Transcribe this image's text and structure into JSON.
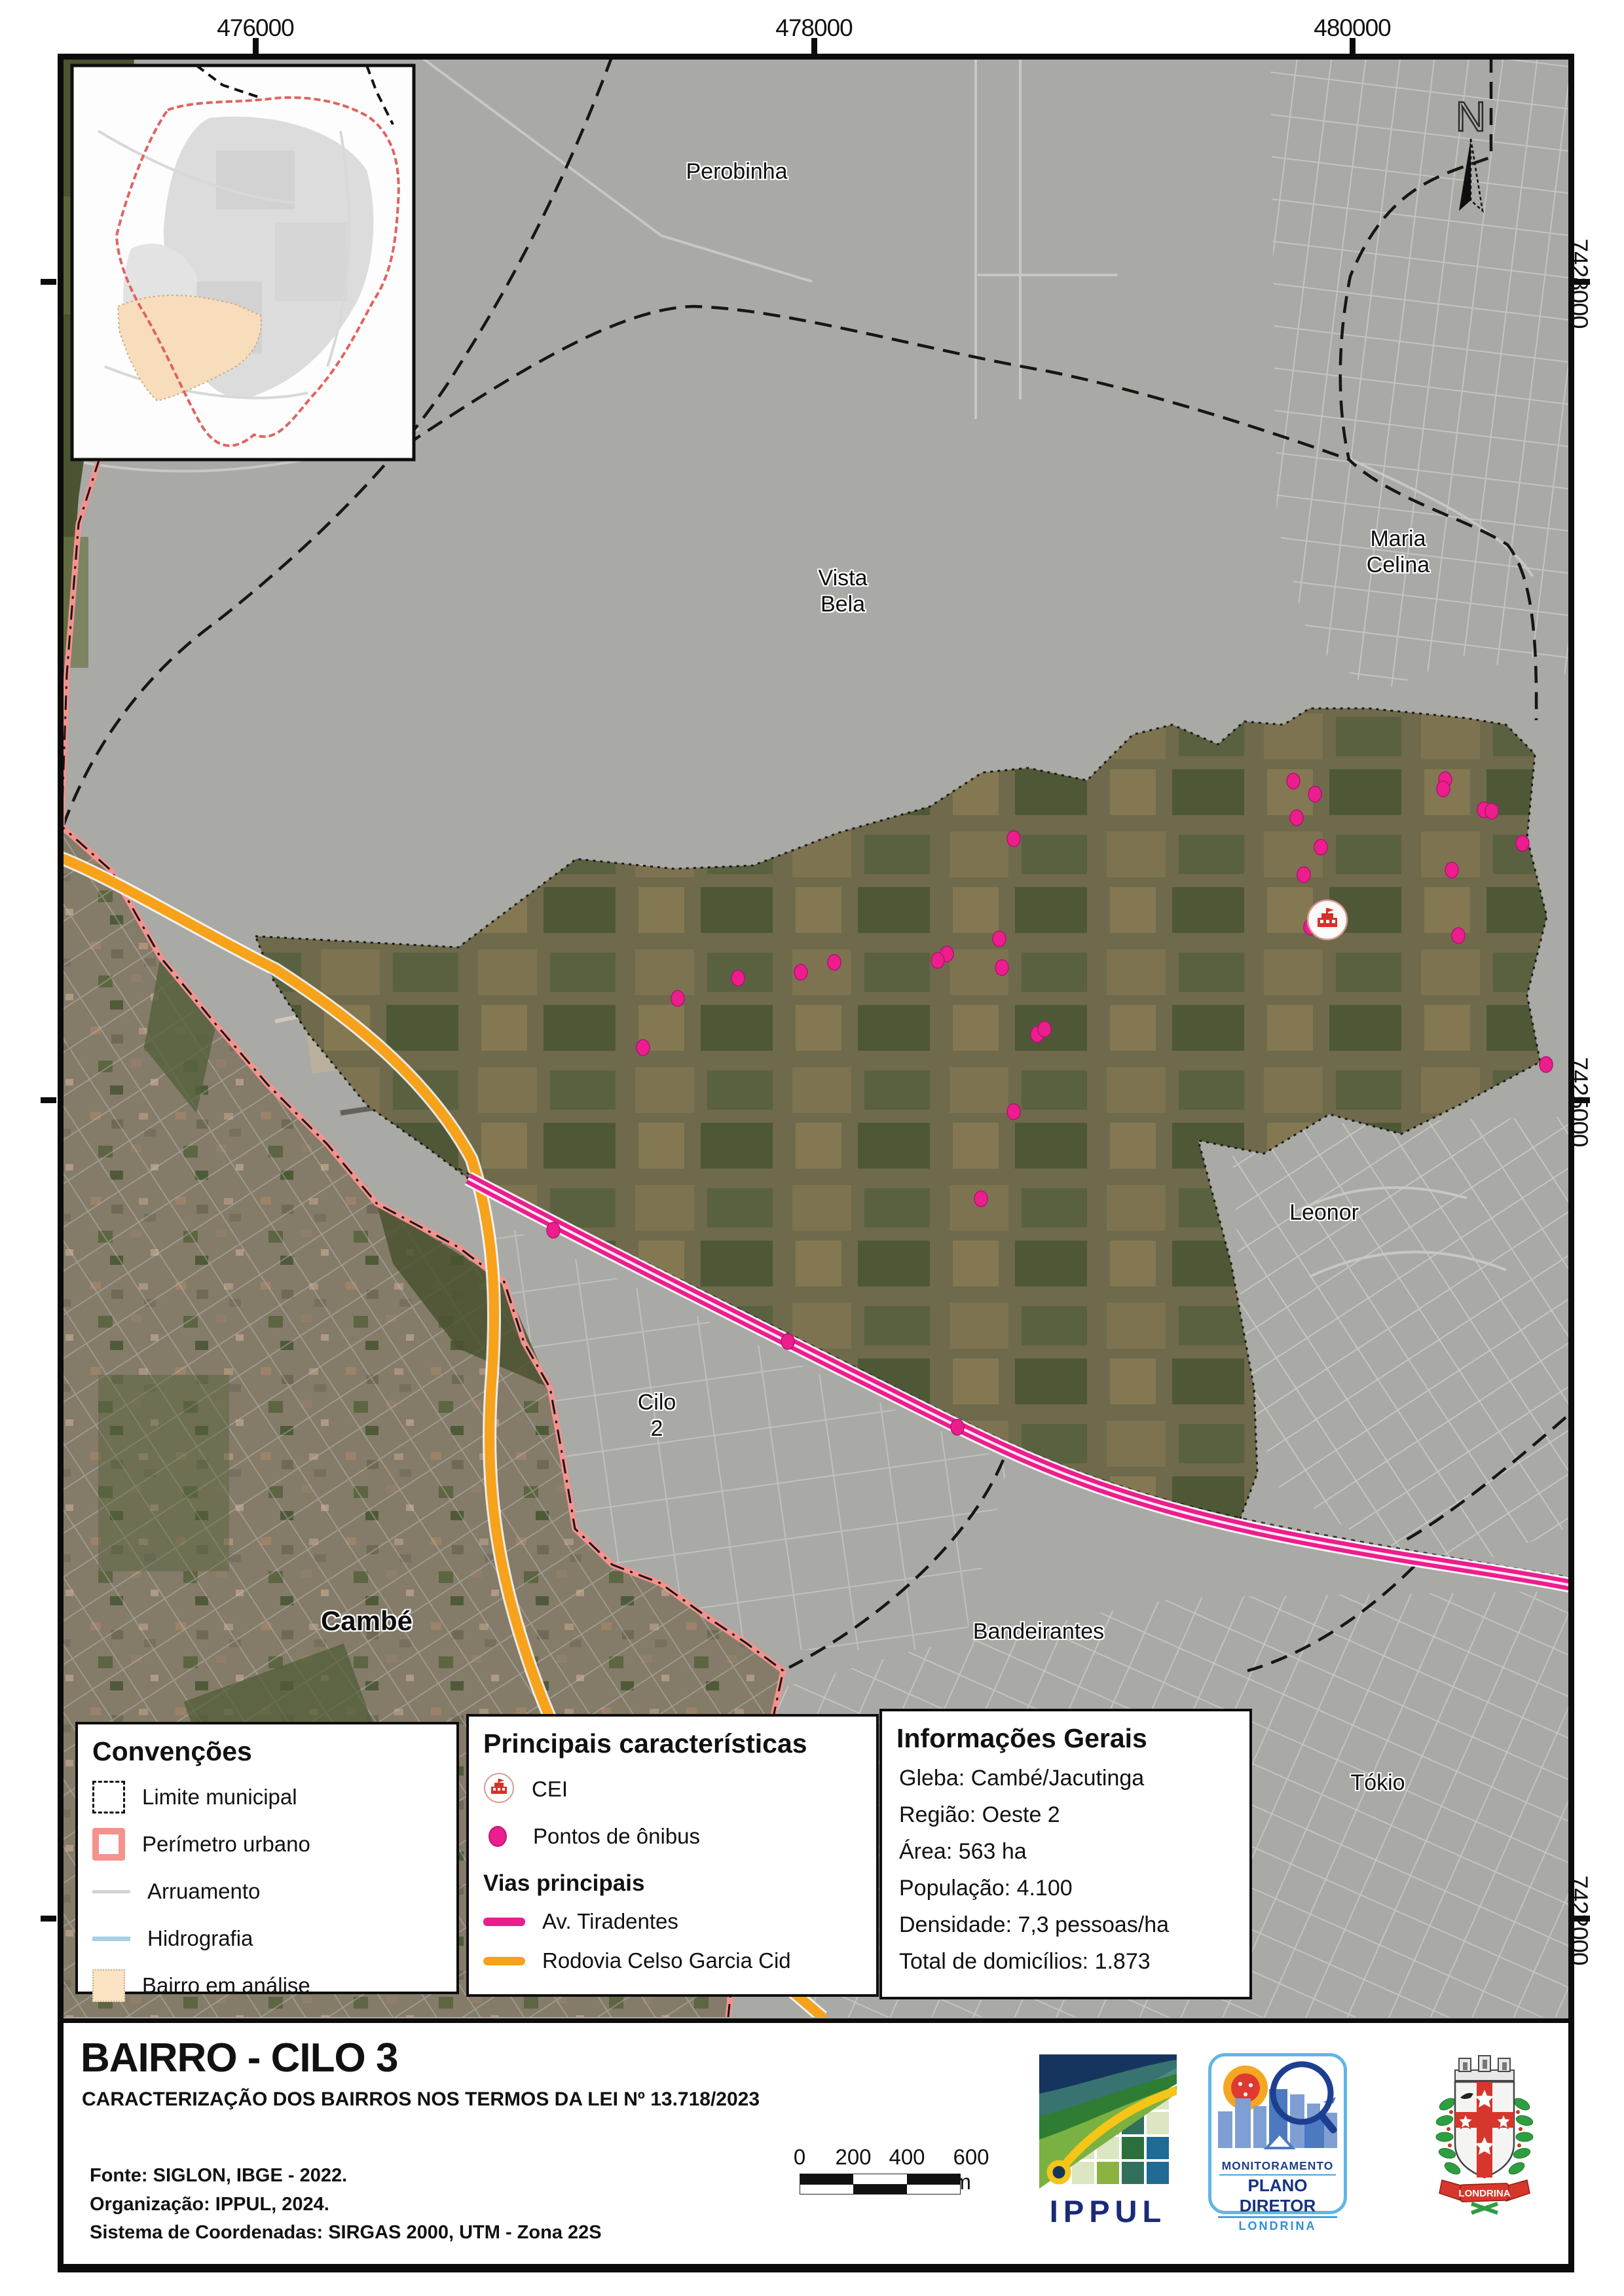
{
  "coordinates": {
    "top_1": "476000",
    "top_2": "478000",
    "top_3": "480000",
    "right_1": "7428000",
    "right_2": "7425000",
    "right_3": "7422000"
  },
  "map_labels": {
    "perobinha": "Perobinha",
    "vista_bela": "Vista\nBela",
    "maria_celina": "Maria\nCelina",
    "leonor": "Leonor",
    "cilo2": "Cilo\n2",
    "cambe": "Cambé",
    "bandeirantes": "Bandeirantes",
    "tokio": "Tókio"
  },
  "north": {
    "label": "N"
  },
  "legend_conventions": {
    "title": "Convenções",
    "item_1": "Limite municipal",
    "item_2": "Perímetro urbano",
    "item_3": "Arruamento",
    "item_4": "Hidrografia",
    "item_5": "Bairro em análise"
  },
  "legend_features": {
    "title": "Principais características",
    "item_cei": "CEI",
    "item_bus": "Pontos de ônibus",
    "subtitle": "Vias principais",
    "road_1": "Av. Tiradentes",
    "road_2": "Rodovia Celso Garcia Cid"
  },
  "info_box": {
    "title": "Informações Gerais",
    "line_1": "Gleba: Cambé/Jacutinga",
    "line_2": "Região: Oeste 2",
    "line_3": "Área: 563 ha",
    "line_4": "População: 4.100",
    "line_5": "Densidade: 7,3 pessoas/ha",
    "line_6": "Total de domicílios: 1.873"
  },
  "title_block": {
    "title": "BAIRRO - CILO 3",
    "subtitle": "CARACTERIZAÇÃO DOS BAIRROS NOS TERMOS DA LEI Nº 13.718/2023",
    "source_1": "Fonte: SIGLON, IBGE - 2022.",
    "source_2": "Organização: IPPUL, 2024.",
    "source_3": "Sistema de Coordenadas: SIRGAS 2000, UTM - Zona 22S"
  },
  "scale_bar": {
    "label_0": "0",
    "label_200": "200",
    "label_400": "400",
    "label_600": "600 m"
  },
  "logos": {
    "ippul": "IPPUL",
    "monit_line_1": "MONITORAMENTO",
    "monit_line_2": "PLANO DIRETOR",
    "monit_line_3": "LONDRINA",
    "coat_ribbon": "LONDRINA"
  },
  "map_points": {
    "cei": [
      2027,
      1405
    ],
    "bus_stops": [
      [
        1548,
        1281
      ],
      [
        1526,
        1434
      ],
      [
        1446,
        1457
      ],
      [
        1432,
        1467
      ],
      [
        1530,
        1478
      ],
      [
        1274,
        1470
      ],
      [
        1223,
        1485
      ],
      [
        1127,
        1494
      ],
      [
        1035,
        1525
      ],
      [
        982,
        1600
      ],
      [
        1584,
        1580
      ],
      [
        1595,
        1572
      ],
      [
        1548,
        1698
      ],
      [
        1498,
        1831
      ],
      [
        845,
        1879
      ],
      [
        1203,
        2049
      ],
      [
        1462,
        2180
      ],
      [
        1975,
        1193
      ],
      [
        2008,
        1213
      ],
      [
        1980,
        1249
      ],
      [
        2017,
        1294
      ],
      [
        1991,
        1336
      ],
      [
        2001,
        1416
      ],
      [
        2207,
        1191
      ],
      [
        2204,
        1205
      ],
      [
        2266,
        1237
      ],
      [
        2278,
        1239
      ],
      [
        2325,
        1288
      ],
      [
        2217,
        1329
      ],
      [
        2227,
        1429
      ],
      [
        2361,
        1626
      ]
    ]
  },
  "colors": {
    "bus_stop": "#EC1E8E",
    "av_tiradentes": "#EC1E8E",
    "rodovia_celso_garcia_cid": "#F7A21B",
    "perimetro_urbano": "#F4928E",
    "bairro_em_analise": "#FBE3C3",
    "hidrografia": "#A9CFE3",
    "arruamento": "#C7C7C3",
    "map_overlay_gray": "#A9A9A5"
  }
}
